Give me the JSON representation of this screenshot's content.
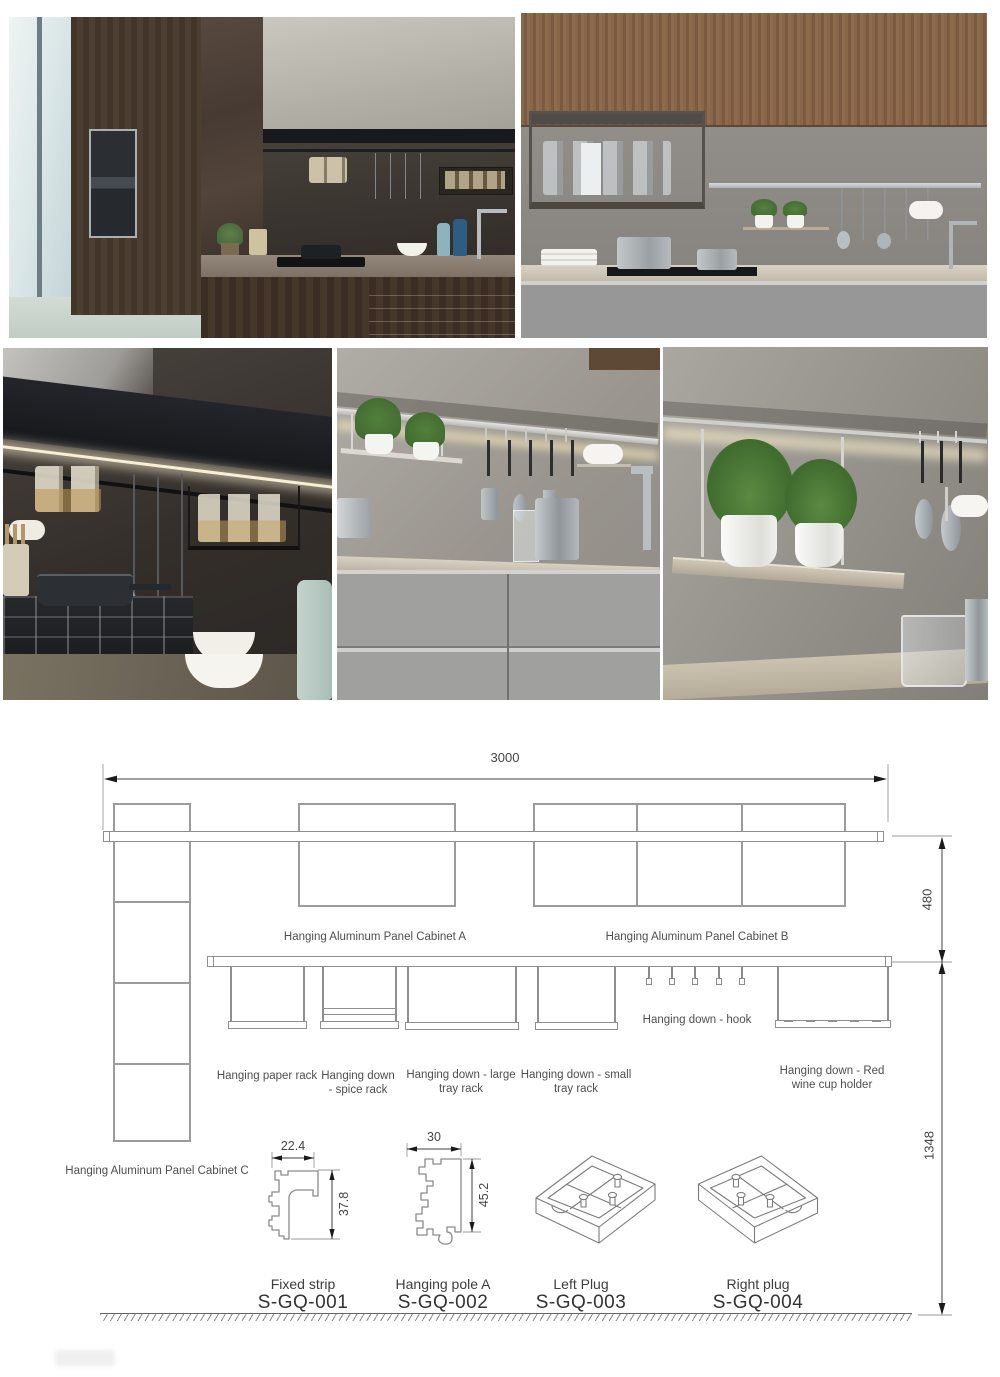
{
  "diagram": {
    "dim_total_width": "3000",
    "dim_rail_height": "480",
    "dim_floor_height": "1348",
    "cabinet_a_label": "Hanging Aluminum Panel Cabinet A",
    "cabinet_b_label": "Hanging Aluminum Panel Cabinet B",
    "cabinet_c_label": "Hanging Aluminum Panel Cabinet C",
    "rack_labels": {
      "paper": "Hanging paper rack",
      "spice_1": "Hanging down",
      "spice_2": "- spice rack",
      "large_1": "Hanging down - large",
      "large_2": "tray rack",
      "small_1": "Hanging down - small",
      "small_2": "tray rack",
      "hook": "Hanging down - hook",
      "wine_1": "Hanging down - Red",
      "wine_2": "wine cup holder"
    },
    "parts": [
      {
        "name": "Fixed strip",
        "code": "S-GQ-001",
        "dim_width": "22.4",
        "dim_height": "37.8"
      },
      {
        "name": "Hanging pole A",
        "code": "S-GQ-002",
        "dim_width": "30",
        "dim_height": "45.2"
      },
      {
        "name": "Left Plug",
        "code": "S-GQ-003"
      },
      {
        "name": "Right plug",
        "code": "S-GQ-004"
      }
    ],
    "colors": {
      "drawing_line": "#9b9b9b",
      "dimension_line": "#3f3f3f",
      "label_text": "#4f4f4f"
    }
  },
  "photos": {
    "colors": {
      "dark_wood": "#42352a",
      "walnut_wood": "#82624a",
      "grey_wall": "#908d88",
      "grey_cabinet": "#979797",
      "dark_marble": "#3a342f",
      "counter_beige": "#c6beb0",
      "led_warm": "#f3e5bd",
      "plant_green": "#527c3c"
    }
  }
}
